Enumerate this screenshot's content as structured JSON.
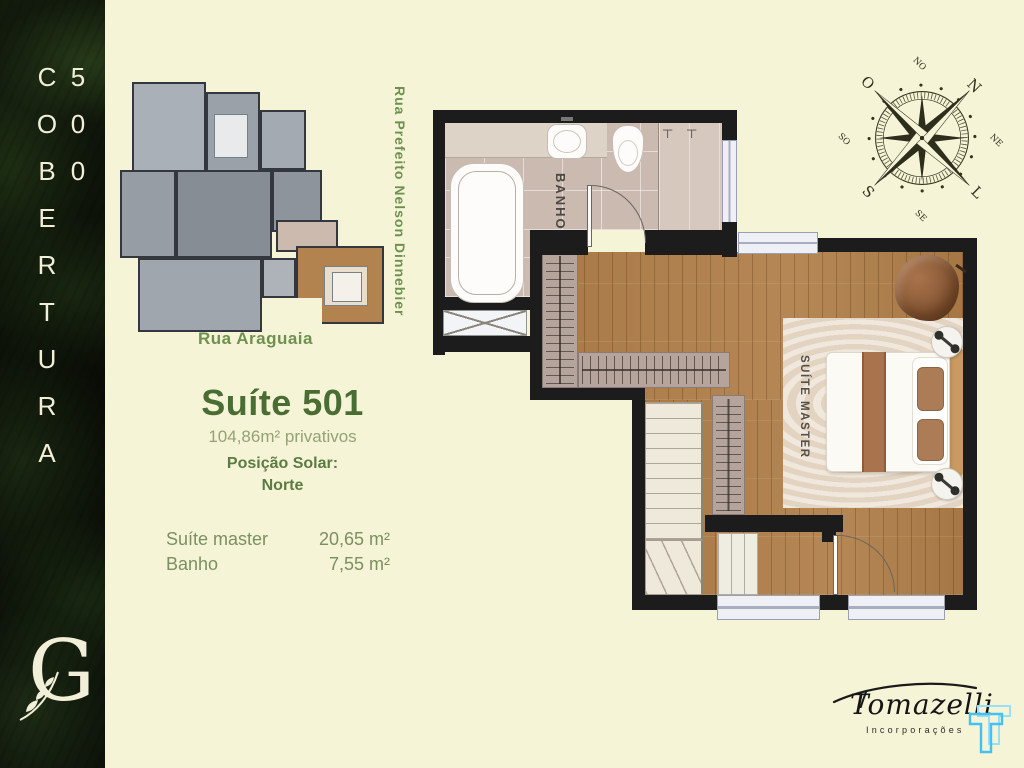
{
  "sidebar": {
    "vertical_title": "COBERTURA 500",
    "monogram": "G"
  },
  "overview": {
    "street_label": "Rua Araguaia"
  },
  "plan": {
    "side_street_label": "Rua Prefeito Nelson Dinnebier",
    "room_labels": {
      "bathroom": "BANHO",
      "bedroom": "SUÍTE MASTER"
    }
  },
  "info": {
    "title": "Suíte 501",
    "subtitle": "104,86m² privativos",
    "solar_label": "Posição Solar:",
    "solar_value": "Norte",
    "areas": [
      {
        "name": "Suíte master",
        "value": "20,65 m²"
      },
      {
        "name": "Banho",
        "value": "7,55 m²"
      }
    ]
  },
  "compass": {
    "points": [
      "N",
      "NE",
      "L",
      "SE",
      "S",
      "SO",
      "O",
      "NO"
    ]
  },
  "brand": {
    "name": "Tomazelli",
    "tagline": "Incorporações"
  },
  "colors": {
    "background": "#f5f4d6",
    "accent_green": "#4a6d33",
    "table_green": "#7c8f60",
    "street_green": "#6f9150",
    "wall": "#1c1c1c",
    "wood": "#b1804a",
    "closet": "#b4a49b",
    "tile": "#cbbab0",
    "brand_blue": "#45c0f2"
  }
}
